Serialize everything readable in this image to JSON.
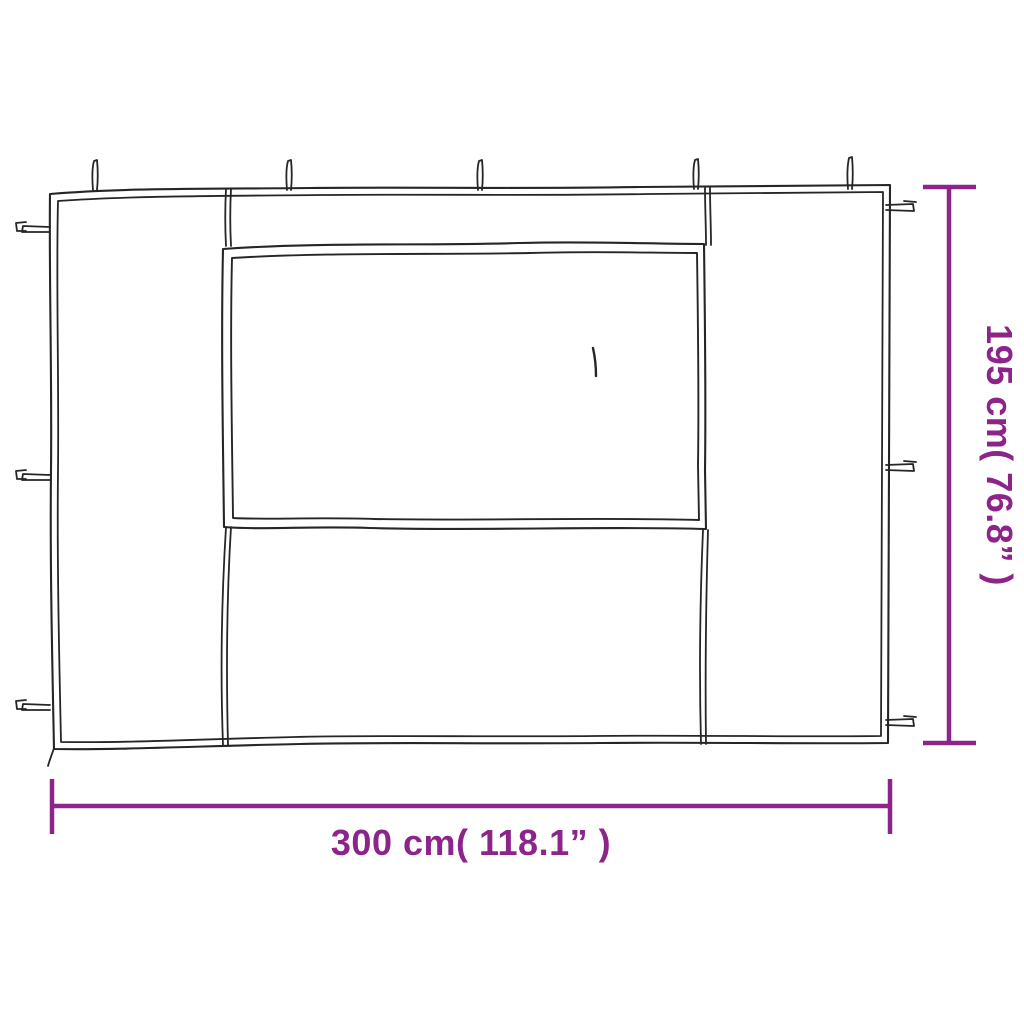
{
  "diagram": {
    "subject": "gazebo-sidewall-panel-with-window",
    "line_color": "#262626",
    "accent_color": "#8C2489",
    "background_color": "#ffffff",
    "dimensions": {
      "width_label": "300 cm( 118.1” )",
      "height_label": "195 cm( 76.8” )"
    },
    "features": {
      "top_ties": 5,
      "left_ties": 3,
      "right_ties": 3,
      "window_panels": 1
    }
  }
}
